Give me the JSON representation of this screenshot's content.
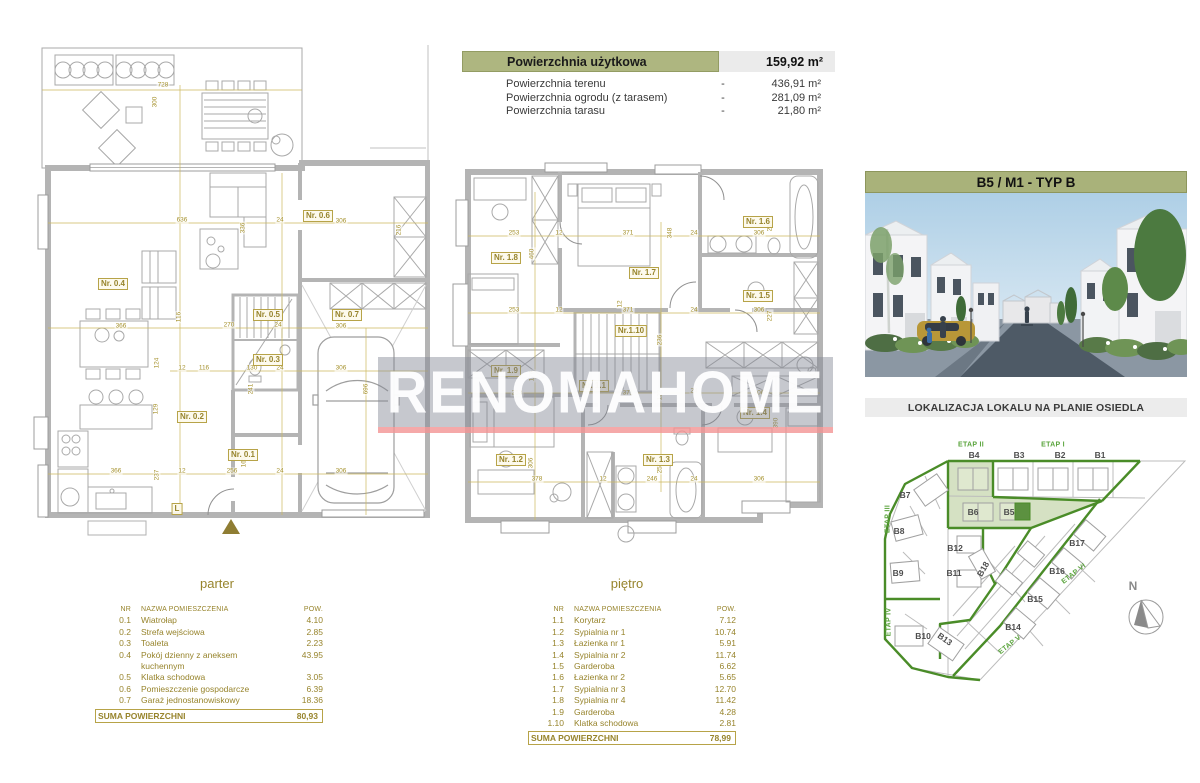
{
  "header_table": {
    "main_label": "Powierzchnia użytkowa",
    "main_value": "159,92 m²",
    "rows": [
      {
        "label": "Powierzchnia terenu",
        "dash": "-",
        "value": "436,91 m²"
      },
      {
        "label": "Powierzchnia ogrodu (z tarasem)",
        "dash": "-",
        "value": "281,09 m²"
      },
      {
        "label": "Powierzchnia tarasu",
        "dash": "-",
        "value": "21,80 m²"
      }
    ]
  },
  "unit_panel": {
    "title": "B5 / M1 - TYP B",
    "site_plan_title": "LOKALIZACJA LOKALU NA PLANIE OSIEDLA",
    "compass_label": "N"
  },
  "site_plan": {
    "etap_labels": [
      "ETAP I",
      "ETAP II",
      "ETAP III",
      "ETAP IV",
      "ETAP V",
      "ETAP VI"
    ],
    "buildings": [
      "B1",
      "B2",
      "B3",
      "B4",
      "B5",
      "B6",
      "B7",
      "B8",
      "B9",
      "B10",
      "B11",
      "B12",
      "B13",
      "B14",
      "B15",
      "B16",
      "B17",
      "B18"
    ],
    "highlighted_building": "B5"
  },
  "plans": {
    "parter": {
      "caption": "parter",
      "rooms": [
        "Nr. 0.4",
        "Nr. 0.6",
        "Nr. 0.5",
        "Nr. 0.7",
        "Nr. 0.3",
        "Nr. 0.2",
        "Nr. 0.1",
        "L"
      ],
      "dims": [
        "728",
        "300",
        "636",
        "336",
        "24",
        "306",
        "216",
        "366",
        "116",
        "270",
        "24",
        "306",
        "124",
        "12",
        "116",
        "130",
        "24",
        "306",
        "129",
        "241",
        "366",
        "237",
        "12",
        "256",
        "24",
        "306",
        "165",
        "696"
      ]
    },
    "pietro": {
      "caption": "piętro",
      "rooms": [
        "Nr. 1.8",
        "Nr. 1.7",
        "Nr. 1.6",
        "Nr. 1.5",
        "Nr.1.10",
        "Nr. 1.9",
        "Nr. 1.1",
        "Nr. 1.2",
        "Nr. 1.3",
        "Nr. 1.4"
      ],
      "dims": [
        "253",
        "12",
        "371",
        "348",
        "24",
        "306",
        "216",
        "460",
        "253",
        "12",
        "371",
        "12",
        "24",
        "306",
        "227",
        "236",
        "176",
        "253",
        "371",
        "122",
        "24",
        "306",
        "390",
        "378",
        "12",
        "246",
        "256",
        "24",
        "306",
        "306"
      ]
    }
  },
  "tables": {
    "parter": {
      "headers": {
        "nr": "NR",
        "name": "NAZWA POMIESZCZENIA",
        "area": "POW."
      },
      "rows": [
        {
          "nr": "0.1",
          "name": "Wiatrołap",
          "area": "4.10"
        },
        {
          "nr": "0.2",
          "name": "Strefa wejściowa",
          "area": "2.85"
        },
        {
          "nr": "0.3",
          "name": "Toaleta",
          "area": "2.23"
        },
        {
          "nr": "0.4",
          "name": "Pokój dzienny z aneksem kuchennym",
          "area": "43.95"
        },
        {
          "nr": "0.5",
          "name": "Klatka schodowa",
          "area": "3.05"
        },
        {
          "nr": "0.6",
          "name": "Pomieszczenie gospodarcze",
          "area": "6.39"
        },
        {
          "nr": "0.7",
          "name": "Garaż jednostanowiskowy",
          "area": "18.36"
        }
      ],
      "sum_label": "SUMA POWIERZCHNI",
      "sum_value": "80,93"
    },
    "pietro": {
      "headers": {
        "nr": "NR",
        "name": "NAZWA POMIESZCZENIA",
        "area": "POW."
      },
      "rows": [
        {
          "nr": "1.1",
          "name": "Korytarz",
          "area": "7.12"
        },
        {
          "nr": "1.2",
          "name": "Sypialnia nr 1",
          "area": "10.74"
        },
        {
          "nr": "1.3",
          "name": "Łazienka nr 1",
          "area": "5.91"
        },
        {
          "nr": "1.4",
          "name": "Sypialnia nr 2",
          "area": "11.74"
        },
        {
          "nr": "1.5",
          "name": "Garderoba",
          "area": "6.62"
        },
        {
          "nr": "1.6",
          "name": "Łazienka nr 2",
          "area": "5.65"
        },
        {
          "nr": "1.7",
          "name": "Sypialnia nr 3",
          "area": "12.70"
        },
        {
          "nr": "1.8",
          "name": "Sypialnia nr 4",
          "area": "11.42"
        },
        {
          "nr": "1.9",
          "name": "Garderoba",
          "area": "4.28"
        },
        {
          "nr": "1.10",
          "name": "Klatka schodowa",
          "area": "2.81"
        }
      ],
      "sum_label": "SUMA POWIERZCHNI",
      "sum_value": "78,99"
    }
  },
  "watermark": {
    "text": "RENOMAHOME"
  },
  "colors": {
    "accent_olive": "#aab37b",
    "plan_gold": "#9a8833",
    "site_green": "#4a8c28",
    "site_green_light": "#d5e1c3",
    "highlight_green": "#5c9140",
    "watermark_red": "#f29494"
  }
}
